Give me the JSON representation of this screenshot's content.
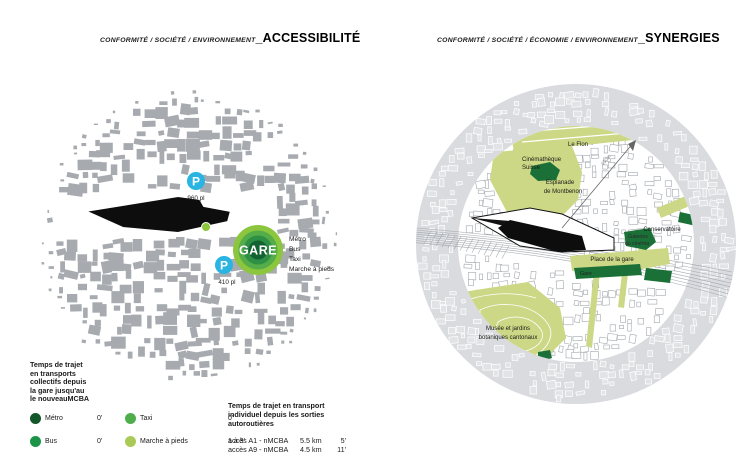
{
  "left_panel": {
    "title_prefix": "CONFORMITÉ / SOCIÉTÉ / ENVIRONNEMENT",
    "title_main": "_ACCESSIBILITÉ",
    "map": {
      "gare_label": "GARE",
      "modes": [
        "Métro",
        "Bus",
        "Taxi",
        "Marche à pieds"
      ],
      "parking_top": {
        "symbol": "P",
        "capacity": "960 pl"
      },
      "parking_bottom": {
        "symbol": "P",
        "capacity": "410 pl"
      }
    },
    "legend": {
      "title_lines": [
        "Temps de trajet",
        "en transports",
        "collectifs depuis",
        "la gare jusqu'au",
        "le nouveauMCBA"
      ],
      "items": [
        {
          "label": "Métro",
          "value": "0'"
        },
        {
          "label": "Bus",
          "value": "0'"
        },
        {
          "label": "Taxi",
          "value": "0'"
        },
        {
          "label": "Marche à pieds",
          "value": "1 à 3'"
        }
      ]
    }
  },
  "right_panel": {
    "title_prefix": "CONFORMITÉ / SOCIÉTÉ / ÉCONOMIE / ENVIRONNEMENT",
    "title_main": "_SYNERGIES",
    "labels": {
      "le_flon": "Le Flon",
      "cinematheque_1": "Cinémathèque",
      "cinematheque_2": "Suisse",
      "esplanade_1": "Esplanade",
      "esplanade_2": "de Montbenon",
      "conservatoire": "Conservatoire",
      "galeries_1": "Galeries",
      "galeries_2": "du cinéma",
      "place_gare": "Place de la gare",
      "gare": "Gare",
      "musee_1": "Musée et jardins",
      "musee_2": "botaniques cantonaux",
      "distance_marker": "400m"
    }
  },
  "travel_info": {
    "title_lines": [
      "Temps de trajet en transport",
      "individuel depuis les sorties",
      "autoroutières"
    ],
    "rows": [
      {
        "label": "accès A1 - nMCBA",
        "distance": "5.5 km",
        "time": "5'"
      },
      {
        "label": "accès A9 - nMCBA",
        "distance": "4.5 km",
        "time": "11'"
      }
    ]
  },
  "colors": {
    "building_gray": "#a7abb0",
    "annulus_gray": "#d9dbdf",
    "parking_blue": "#29b4e2",
    "gare_ring_outer": "#8cc63e",
    "gare_ring_2": "#54ad48",
    "gare_ring_3": "#2e9045",
    "gare_center": "#136231",
    "metro_green": "#14572a",
    "bus_green": "#1b9447",
    "taxi_green": "#4fae4b",
    "walk_green": "#a9ca57",
    "highlight_dark_green": "#1b7038",
    "park_light_green": "#ccd885"
  }
}
